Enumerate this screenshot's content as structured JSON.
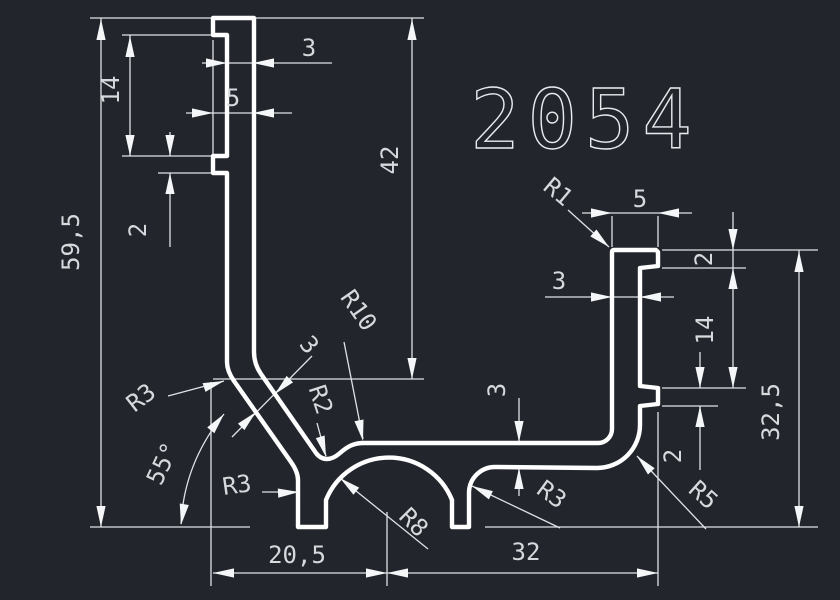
{
  "title": {
    "part_number": "2054"
  },
  "colors": {
    "background": "#22262c",
    "profile_line": "#ffffff",
    "dimension_line": "#dfe3e7",
    "text": "#d6dadd"
  },
  "dims": {
    "overall_height": "59,5",
    "upper_depth": "42",
    "top_wall_thickness": "3",
    "left_hook_width": "5",
    "left_tab_offset": "14",
    "left_tab_height": "2",
    "corner_radius_r1": "R1",
    "right_hook_width": "5",
    "right_hook_height": "2",
    "right_wall_thickness": "3",
    "right_tab_offset": "14",
    "right_tab_height": "2",
    "right_height": "32,5",
    "fillet_r5": "R5",
    "fillet_r3_right_foot": "R3",
    "base_thickness": "3",
    "arch_radius_r8": "R8",
    "bottom_width_left": "20,5",
    "bottom_width_right": "32",
    "diagonal_angle": "55°",
    "fillet_r3_upper_corner": "R3",
    "fillet_r3_left_foot": "R3",
    "diagonal_thickness": "3",
    "fillet_r10": "R10",
    "fillet_r2": "R2"
  }
}
